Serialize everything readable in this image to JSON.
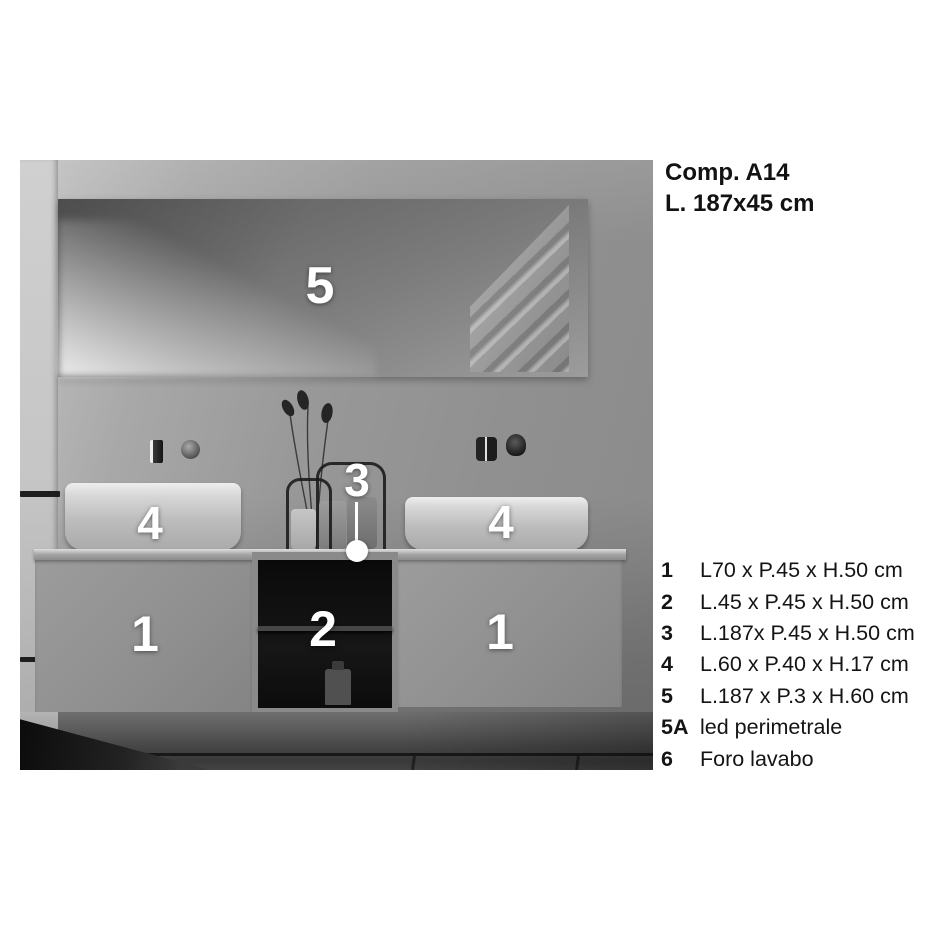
{
  "header": {
    "line1": "Comp. A14",
    "line2": "L. 187x45 cm"
  },
  "photo": {
    "markers": {
      "mirror": "5",
      "countertop": "3",
      "basin_left": "4",
      "basin_right": "4",
      "door_left": "1",
      "open_shelf": "2",
      "door_right": "1"
    }
  },
  "legend": {
    "items": [
      {
        "key": "1",
        "label": "L70 x P.45 x H.50 cm"
      },
      {
        "key": "2",
        "label": "L.45 x P.45 x H.50 cm"
      },
      {
        "key": "3",
        "label": "L.187x P.45 x H.50 cm"
      },
      {
        "key": "4",
        "label": "L.60 x P.40 x H.17 cm"
      },
      {
        "key": "5",
        "label": "L.187 x P.3 x H.60 cm"
      },
      {
        "key": "5A",
        "label": "led perimetrale"
      },
      {
        "key": "6",
        "label": "Foro lavabo"
      }
    ]
  }
}
